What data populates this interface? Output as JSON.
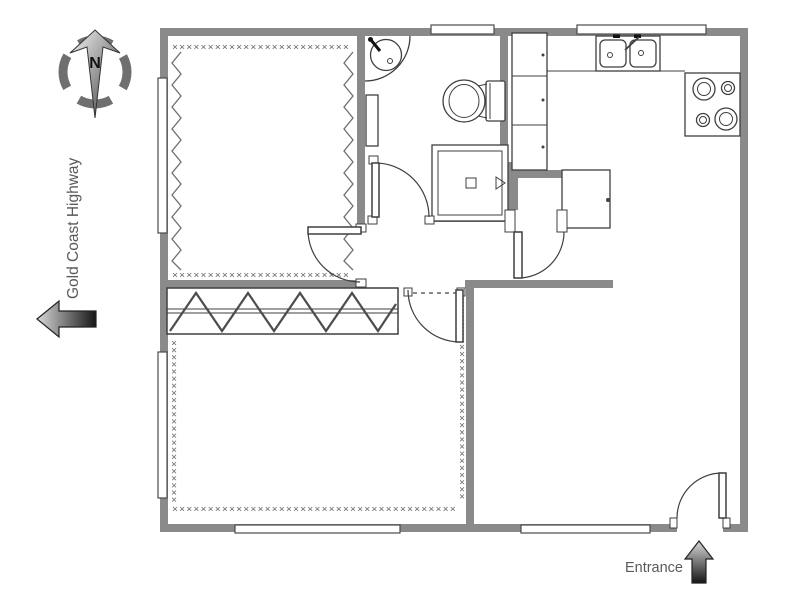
{
  "labels": {
    "highway": "Gold Coast Highway",
    "entrance": "Entrance",
    "compass_north": "N"
  },
  "colors": {
    "wall": "#8a8a8a",
    "outline": "#3f3f3f",
    "pattern": "#6f6f6f",
    "label_text": "#595959",
    "arrow_dark": "#161616",
    "arrow_light": "#d8d8d8",
    "background": "#ffffff"
  },
  "floor_plan": {
    "rooms": [
      "bedroom-1",
      "bathroom",
      "kitchen",
      "hallway",
      "bedroom-2",
      "living-room"
    ],
    "fixtures": [
      "corner-basin",
      "wall-shelf",
      "toilet",
      "shower",
      "tall-cabinets",
      "double-sink",
      "cooktop",
      "refrigerator",
      "wardrobe"
    ],
    "patterns": {
      "x25": "×××××××××××××××××××××××××",
      "x23": "×××××××××××××××××××××××",
      "x29": "×××××××××××××××××××××××××××××",
      "x40": "××××××××××××××××××××××××××××××××××××××××"
    }
  }
}
